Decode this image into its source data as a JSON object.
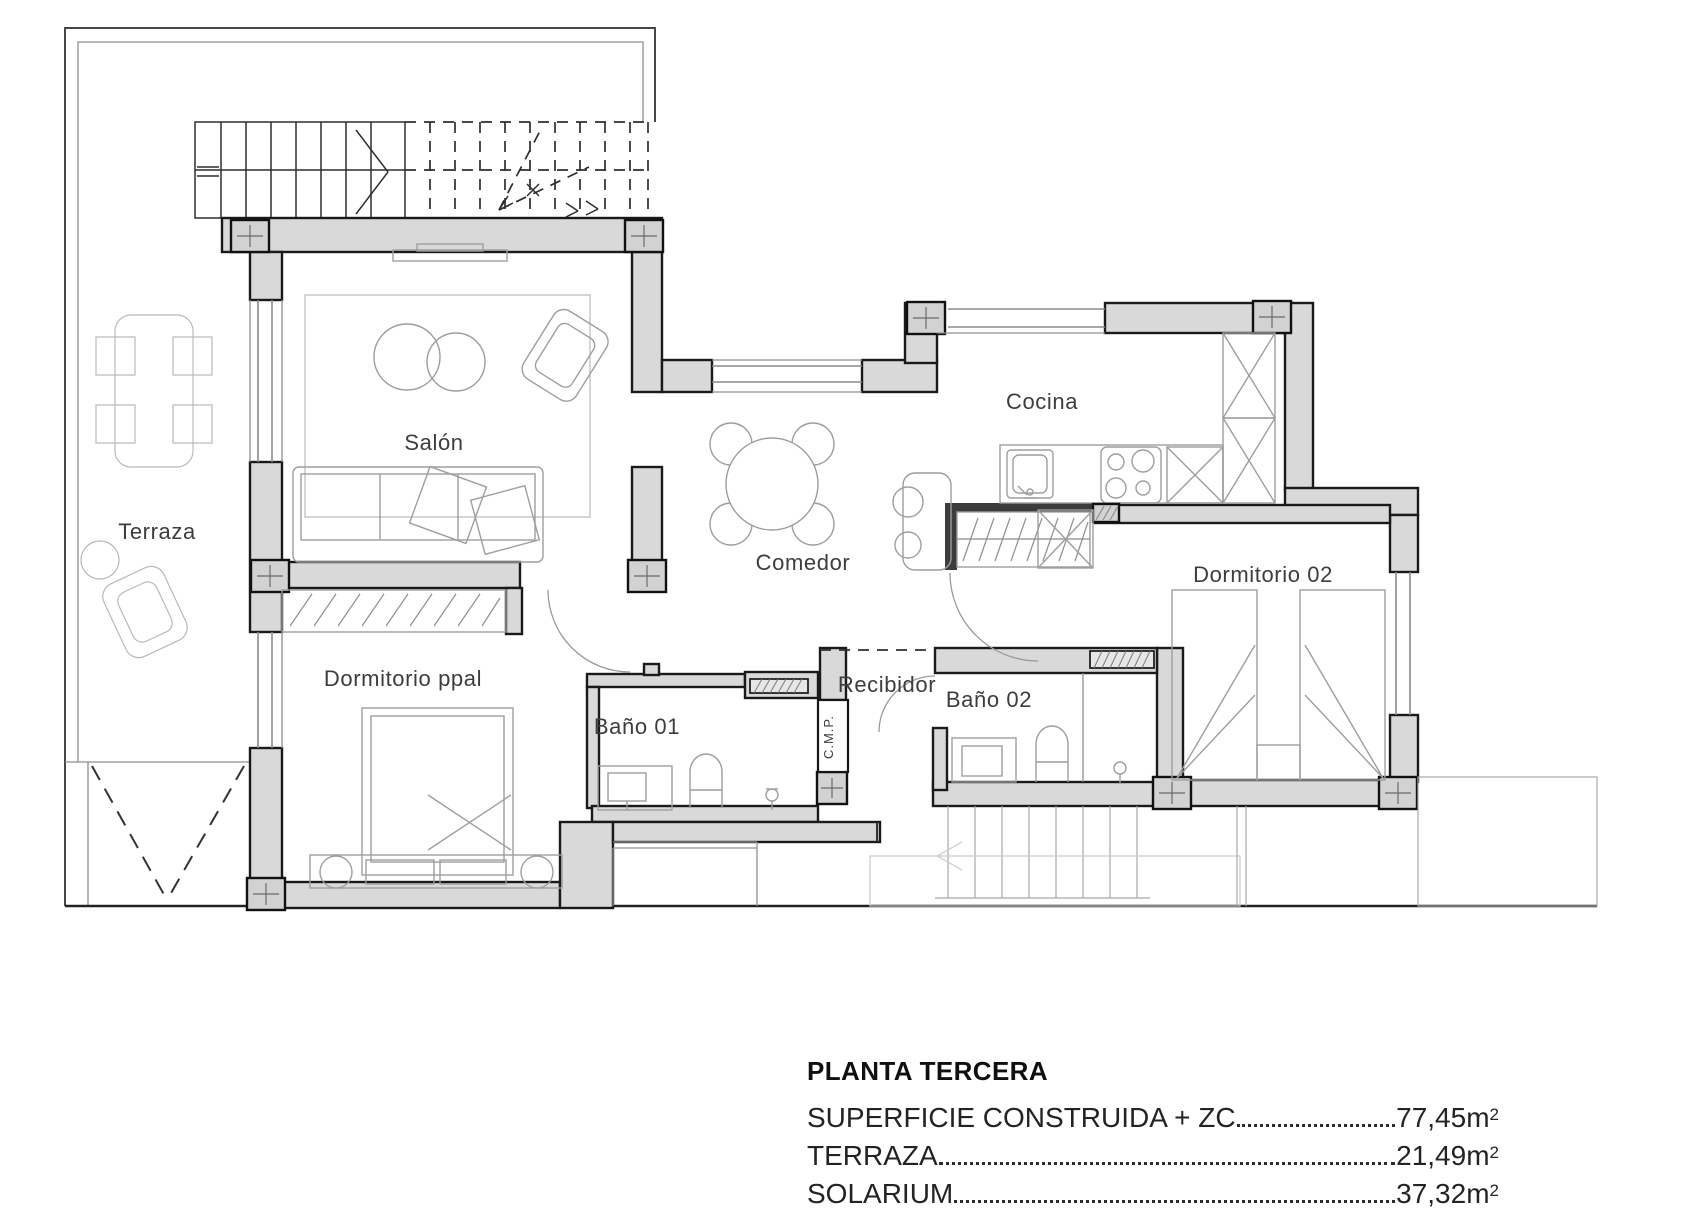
{
  "rooms": {
    "terraza": "Terraza",
    "salon": "Salón",
    "cocina": "Cocina",
    "comedor": "Comedor",
    "dormitorio_ppal": "Dormitorio ppal",
    "bano01": "Baño 01",
    "cmp": "C.M.P.",
    "recibidor": "Recibidor",
    "bano02": "Baño 02",
    "dormitorio02": "Dormitorio 02"
  },
  "legend": {
    "title": "PLANTA TERCERA",
    "items": [
      {
        "label": "SUPERFICIE CONSTRUIDA + ZC",
        "value": "77,45",
        "unit": "m",
        "sup": "2"
      },
      {
        "label": "TERRAZA",
        "value": "21,49",
        "unit": "m",
        "sup": "2"
      },
      {
        "label": "SOLARIUM",
        "value": "37,32",
        "unit": "m",
        "sup": "2"
      }
    ]
  }
}
